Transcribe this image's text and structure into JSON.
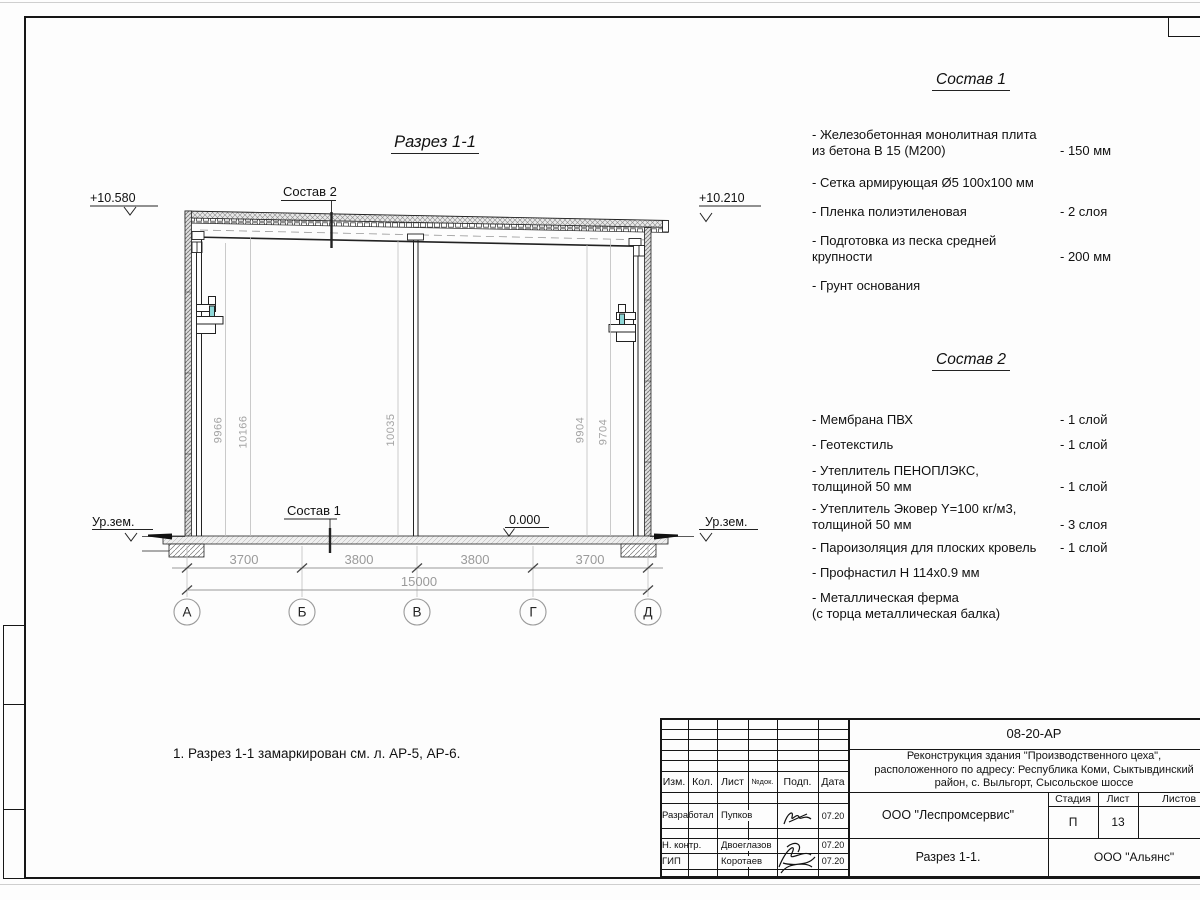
{
  "drawing": {
    "title": "Разрез 1-1",
    "leader_top": "Состав 2",
    "leader_bottom": "Состав 1",
    "elevations": {
      "left": "+10.580",
      "right": "+10.210",
      "zero": "0.000"
    },
    "ground_label_left": "Ур.зем.",
    "ground_label_right": "Ур.зем.",
    "vertical_dims": [
      "9966",
      "10166",
      "10035",
      "9904",
      "9704"
    ],
    "span_dims": [
      "3700",
      "3800",
      "3800",
      "3700"
    ],
    "total_dim": "15000",
    "axes": [
      "А",
      "Б",
      "В",
      "Г",
      "Д"
    ]
  },
  "note": "1. Разрез 1-1 замаркирован см. л. АР-5, АР-6.",
  "compositions": [
    {
      "title": "Состав 1",
      "items": [
        {
          "name": "- Железобетонная  монолитная плита\nиз бетона В 15 (М200)",
          "value": "- 150 мм"
        },
        {
          "name": "- Сетка армирующая Ø5 100х100 мм",
          "value": ""
        },
        {
          "name": "- Пленка полиэтиленовая",
          "value": "-  2 слоя"
        },
        {
          "name": "- Подготовка из песка средней\nкрупности",
          "value": "- 200 мм"
        },
        {
          "name": "- Грунт основания",
          "value": ""
        }
      ]
    },
    {
      "title": "Состав 2",
      "items": [
        {
          "name": "- Мембрана ПВХ",
          "value": "- 1 слой"
        },
        {
          "name": "- Геотекстиль",
          "value": "- 1 слой"
        },
        {
          "name": "- Утеплитель ПЕНОПЛЭКС,\nтолщиной 50 мм",
          "value": "- 1 слой"
        },
        {
          "name": "- Утеплитель Эковер Y=100 кг/м3,\nтолщиной 50 мм",
          "value": "- 3 слоя"
        },
        {
          "name": "- Пароизоляция для плоских кровель",
          "value": "- 1 слой"
        },
        {
          "name": "- Профнастил Н 114х0.9 мм",
          "value": ""
        },
        {
          "name": "- Металлическая ферма\n(с торца металлическая балка)",
          "value": ""
        }
      ]
    }
  ],
  "title_block": {
    "doc_number": "08-20-АР",
    "project": "Реконструкция здания \"Производственного цеха\",\nрасположенного по адресу: Республика Коми, Сыктывдинский\nрайон, с. Выльгорт, Сысольское шоссе",
    "organization": "ООО \"Леспромсервис\"",
    "sheet_title": "Разрез 1-1.",
    "contractor": "ООО \"Альянс\"",
    "stage_label": "Стадия",
    "sheet_label": "Лист",
    "sheets_label": "Листов",
    "stage": "П",
    "sheet": "13",
    "cols": {
      "izm": "Изм.",
      "kol": "Кол.",
      "list": "Лист",
      "doc": "№док.",
      "podp": "Подп.",
      "data": "Дата"
    },
    "rows": [
      {
        "role": "Разработал",
        "name": "Пупков",
        "date": "07.20"
      },
      {
        "role": "Н. контр.",
        "name": "Двоеглазов",
        "date": "07.20"
      },
      {
        "role": "ГИП",
        "name": "Коротаев",
        "date": "07.20"
      }
    ]
  }
}
